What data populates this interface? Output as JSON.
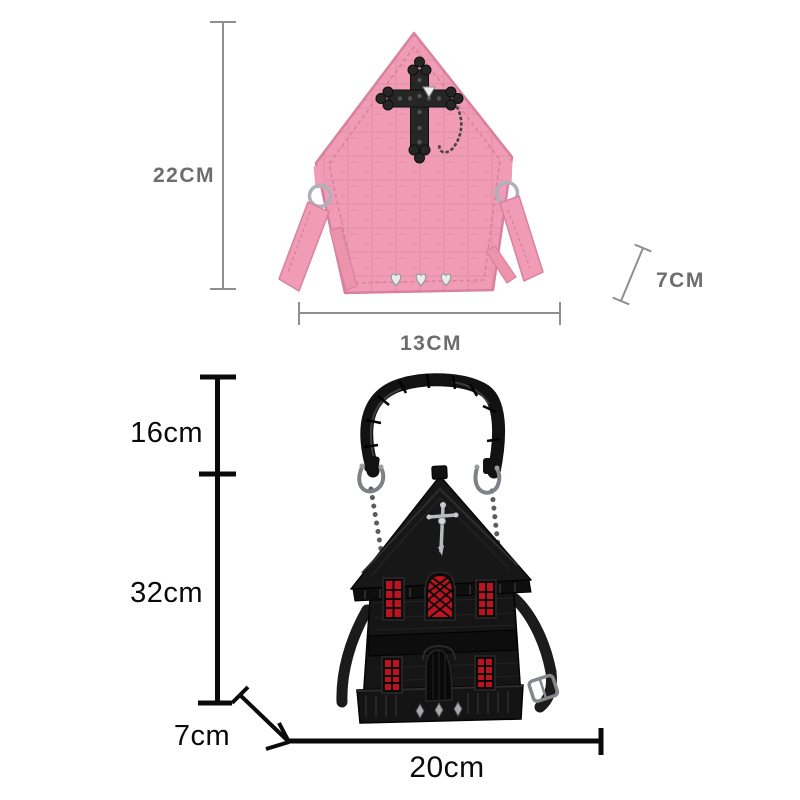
{
  "page": {
    "background": "#ffffff",
    "description_labels_only": true
  },
  "top_product": {
    "name": "pink-church-house-crossbody-bag",
    "height_label": "22CM",
    "width_label": "13CM",
    "depth_label": "7CM"
  },
  "bottom_product": {
    "name": "black-haunted-house-handbag",
    "handle_height_label": "16cm",
    "body_height_label": "32cm",
    "depth_label": "7cm",
    "width_label": "20cm"
  },
  "colors": {
    "pink_bag": "#f09cb6",
    "pink_bag_stroke": "#d9829f",
    "pink_bag_stitch": "#d17e9b",
    "black_bag": "#151515",
    "window_red": "#bb1320",
    "hardware_silver": "#aeb2b8",
    "dim_gray_line": "#8f8f8f",
    "dim_gray_text": "#6d6d6d",
    "dim_black": "#0a0a0a"
  }
}
